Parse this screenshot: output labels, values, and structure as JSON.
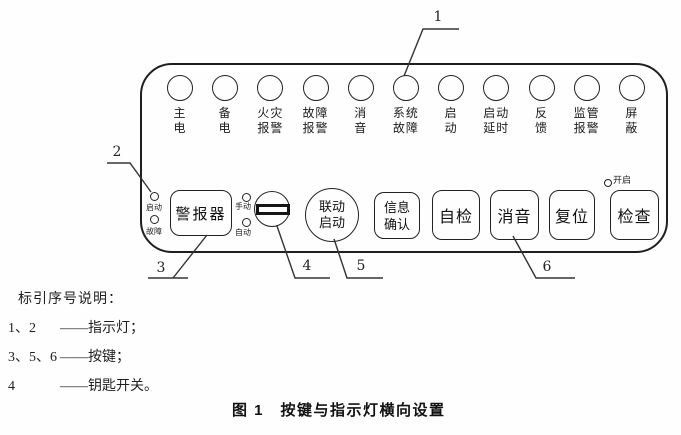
{
  "panel": {
    "indicators": [
      {
        "line1": "主",
        "line2": "电"
      },
      {
        "line1": "备",
        "line2": "电"
      },
      {
        "line1": "火灾",
        "line2": "报警"
      },
      {
        "line1": "故障",
        "line2": "报警"
      },
      {
        "line1": "消",
        "line2": "音"
      },
      {
        "line1": "系统",
        "line2": "故障"
      },
      {
        "line1": "启",
        "line2": "动"
      },
      {
        "line1": "启动",
        "line2": "延时"
      },
      {
        "line1": "反",
        "line2": "馈"
      },
      {
        "line1": "监管",
        "line2": "报警"
      },
      {
        "line1": "屏",
        "line2": "蔽"
      }
    ],
    "sounder": {
      "led_start": "启动",
      "led_fault": "故障",
      "button": "警报器"
    },
    "key_switch": {
      "led_manual": "手动",
      "led_auto": "自动"
    },
    "linkage": {
      "line1": "联动",
      "line2": "启动"
    },
    "info": {
      "line1": "信息",
      "line2": "确认"
    },
    "buttons": {
      "self_test": "自检",
      "mute": "消音",
      "reset": "复位",
      "check": "检查"
    },
    "check_led": "开启"
  },
  "callouts": {
    "c1": "1",
    "c2": "2",
    "c3": "3",
    "c4": "4",
    "c5": "5",
    "c6": "6"
  },
  "legend": {
    "title": "标引序号说明：",
    "items": [
      {
        "num": "1、2",
        "desc": "——指示灯；"
      },
      {
        "num": "3、5、6",
        "desc": "——按键；"
      },
      {
        "num": "4",
        "desc": "——钥匙开关。"
      }
    ]
  },
  "caption": "图 1　按键与指示灯横向设置"
}
